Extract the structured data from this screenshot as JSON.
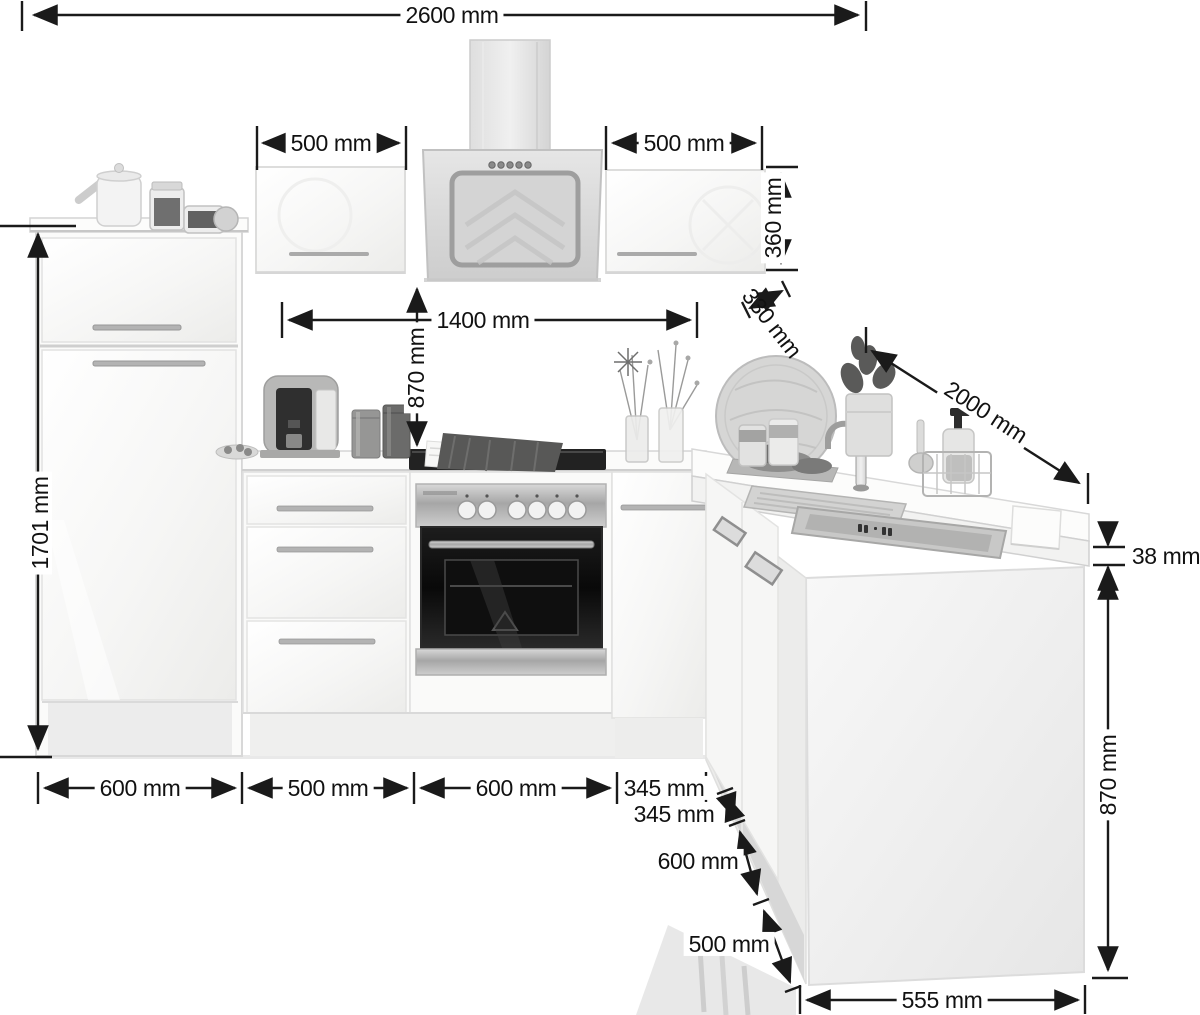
{
  "dimensions": {
    "total_width": "2600 mm",
    "wall_cabinet_left_width": "500 mm",
    "wall_cabinet_right_width": "500 mm",
    "wall_cabinet_height": "360 mm",
    "wall_cabinet_depth": "330 mm",
    "wall_run_span": "1400 mm",
    "worktop_to_wall_units": "870 mm",
    "right_run_length": "2000 mm",
    "tall_cabinet_height": "1701 mm",
    "base_run_widths": {
      "cabinet_1": "600 mm",
      "cabinet_2": "500 mm",
      "cabinet_3": "600 mm",
      "cabinet_4": "345 mm"
    },
    "right_run_widths": {
      "cabinet_1": "345 mm",
      "cabinet_2": "600 mm",
      "cabinet_3": "500 mm"
    },
    "peninsula_end_width": "555 mm",
    "worktop_thickness": "38 mm",
    "base_height": "870 mm"
  }
}
